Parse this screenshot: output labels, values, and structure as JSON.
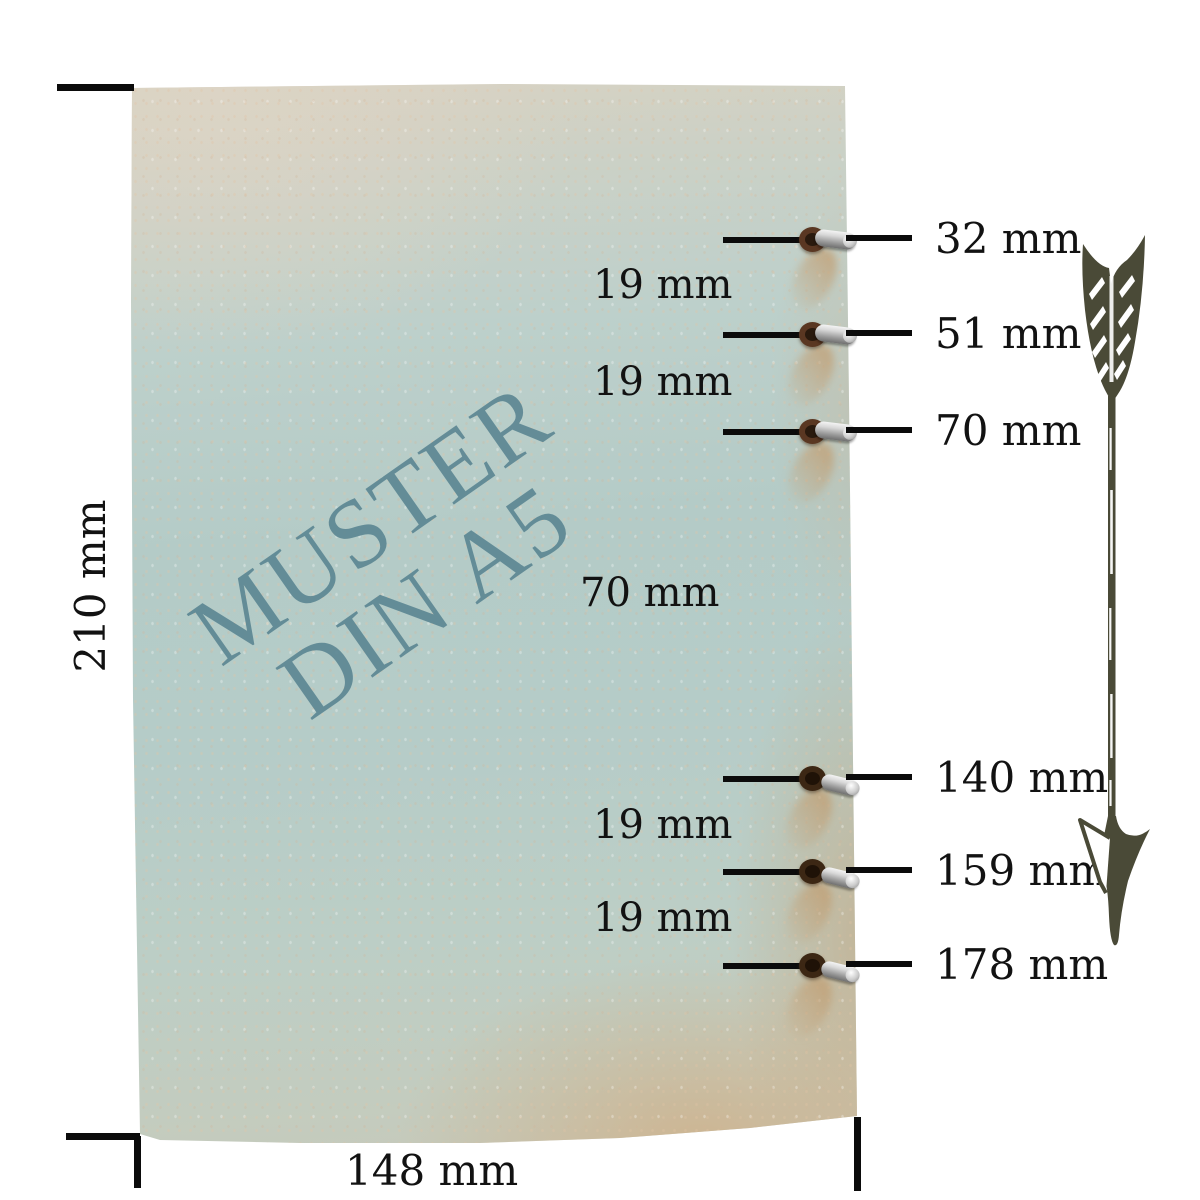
{
  "meta": {
    "background": "#ffffff",
    "ink_color": "#0b0b0b",
    "watermark_color": "#5c8792",
    "paper_blue": "#b4cbc7",
    "paper_tan": "#d9d2c2",
    "arrow_color": "#4a4a37"
  },
  "paper": {
    "watermark_line1": "MUSTER",
    "watermark_line2": "DIN A5"
  },
  "dimensions": {
    "height": {
      "label": "210 mm"
    },
    "width": {
      "label": "148 mm"
    }
  },
  "holes": [
    {
      "label": "32 mm"
    },
    {
      "label": "51 mm"
    },
    {
      "label": "70 mm"
    },
    {
      "label": "140 mm"
    },
    {
      "label": "159 mm"
    },
    {
      "label": "178 mm"
    }
  ],
  "gaps": [
    {
      "label": "19 mm"
    },
    {
      "label": "19 mm"
    },
    {
      "label": "70 mm"
    },
    {
      "label": "19 mm"
    },
    {
      "label": "19 mm"
    }
  ],
  "icons": {
    "arrow": "down-arrow-illustration"
  }
}
